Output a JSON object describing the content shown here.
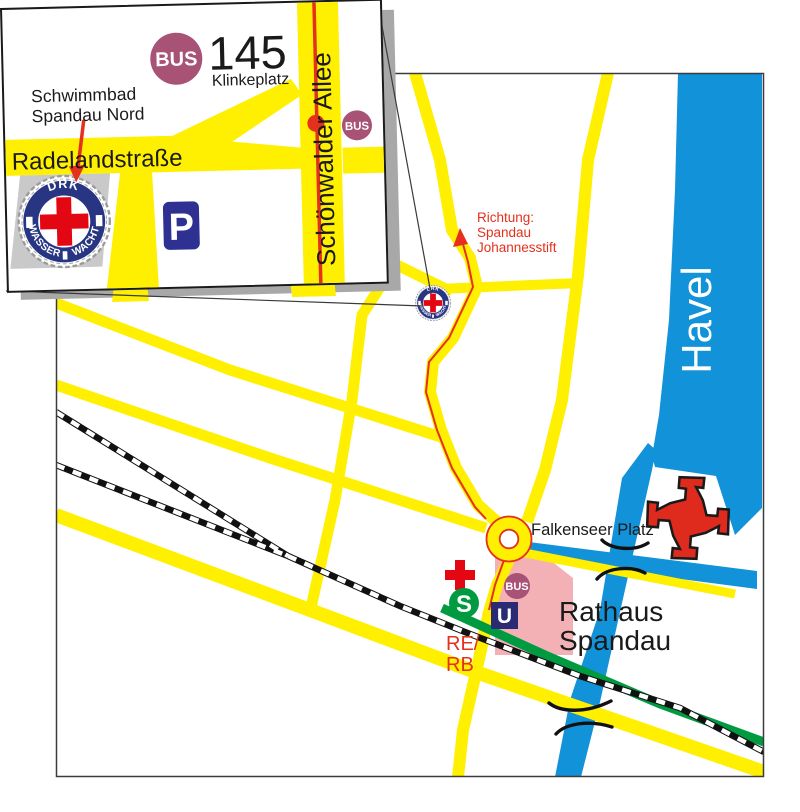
{
  "colors": {
    "road_yellow": "#ffef00",
    "water_blue": "#1292d8",
    "sbahn_green": "#009b40",
    "signal_red": "#e30613",
    "route_red": "#e5301d",
    "bus_maroon": "#a85276",
    "parking_navy": "#2e3192",
    "ubahn_navy": "#2b2a74",
    "logo_ring_blue": "#283583",
    "citadel_red": "#df2b1e",
    "building_pink": "#f3b1b6",
    "shadow_gray": "#a8a8a8",
    "site_gray": "#c9c9c9"
  },
  "inset": {
    "bus_circle_label": "BUS",
    "line_number": "145",
    "stop_name": "Klinkeplatz",
    "pool_label_line1": "Schwimmbad",
    "pool_label_line2": "Spandau Nord",
    "street_horizontal": "Radelandstraße",
    "street_vertical": "Schönwalder Allee",
    "bus_badge_label": "BUS",
    "parking_label": "P"
  },
  "logo": {
    "org": "DRK",
    "ring_left": "WASSER",
    "ring_right": "WACHT"
  },
  "map": {
    "river_label": "Havel",
    "direction_line1": "Richtung:",
    "direction_line2": "Spandau",
    "direction_line3": "Johannesstift",
    "square_label": "Falkenseer Platz",
    "townhall_line1": "Rathaus",
    "townhall_line2": "Spandau",
    "regional_line1": "RE/",
    "regional_line2": "RB",
    "sbahn_label": "S",
    "ubahn_label": "U",
    "bus_badge_label": "BUS"
  }
}
